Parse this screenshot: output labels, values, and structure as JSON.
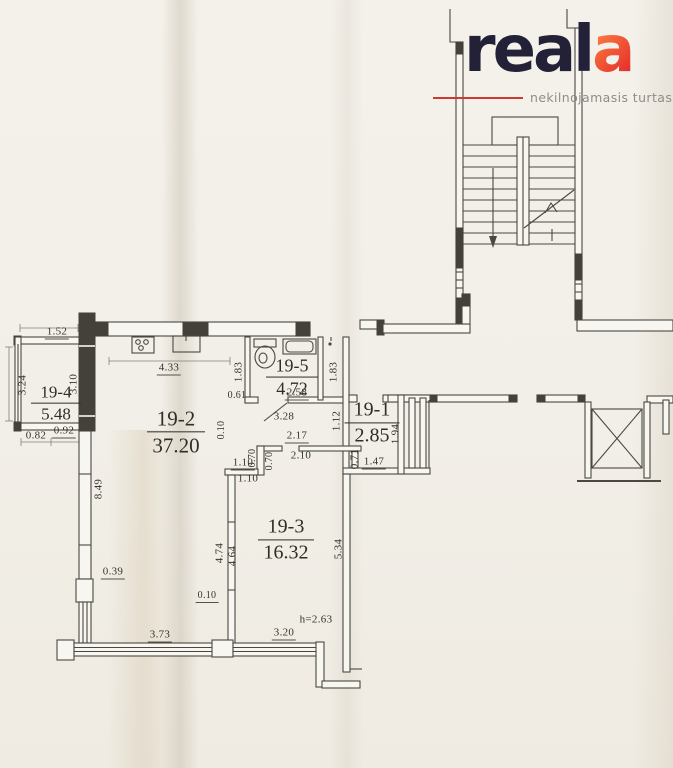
{
  "logo": {
    "brand_dark": "real",
    "brand_accent": "a",
    "tagline": "nekilnojamasis turtas",
    "colors": {
      "dark": "#232138",
      "accent_start": "#ff8a41",
      "accent_end": "#e7332e",
      "tagline": "#8f8d8a",
      "rule": "#cc3a31"
    }
  },
  "plan": {
    "rooms": [
      {
        "id": "19-4",
        "area": "5.48"
      },
      {
        "id": "19-2",
        "area": "37.20"
      },
      {
        "id": "19-5",
        "area": "4.72"
      },
      {
        "id": "19-1",
        "area": "2.85"
      },
      {
        "id": "19-3",
        "area": "16.32"
      }
    ],
    "dims": [
      "1.52",
      "3.24",
      "3.10",
      "4.33",
      "1.83",
      "0.61",
      "2.58",
      "3.28",
      "1.83",
      "0.82",
      "0.92",
      "8.49",
      "0.10",
      "1.12",
      "1.94",
      "0.71",
      "1.47",
      "2.17",
      "2.10",
      "0.70",
      "0.70",
      "1.10",
      "1.10",
      "4.74",
      "4.64",
      "5.34",
      "0.39",
      "0.10",
      "3.73",
      "3.20",
      "h=2.63"
    ],
    "colors": {
      "paper": "#f2efe8",
      "ink": "#4a4840",
      "wall_fill": "#44403a"
    }
  }
}
